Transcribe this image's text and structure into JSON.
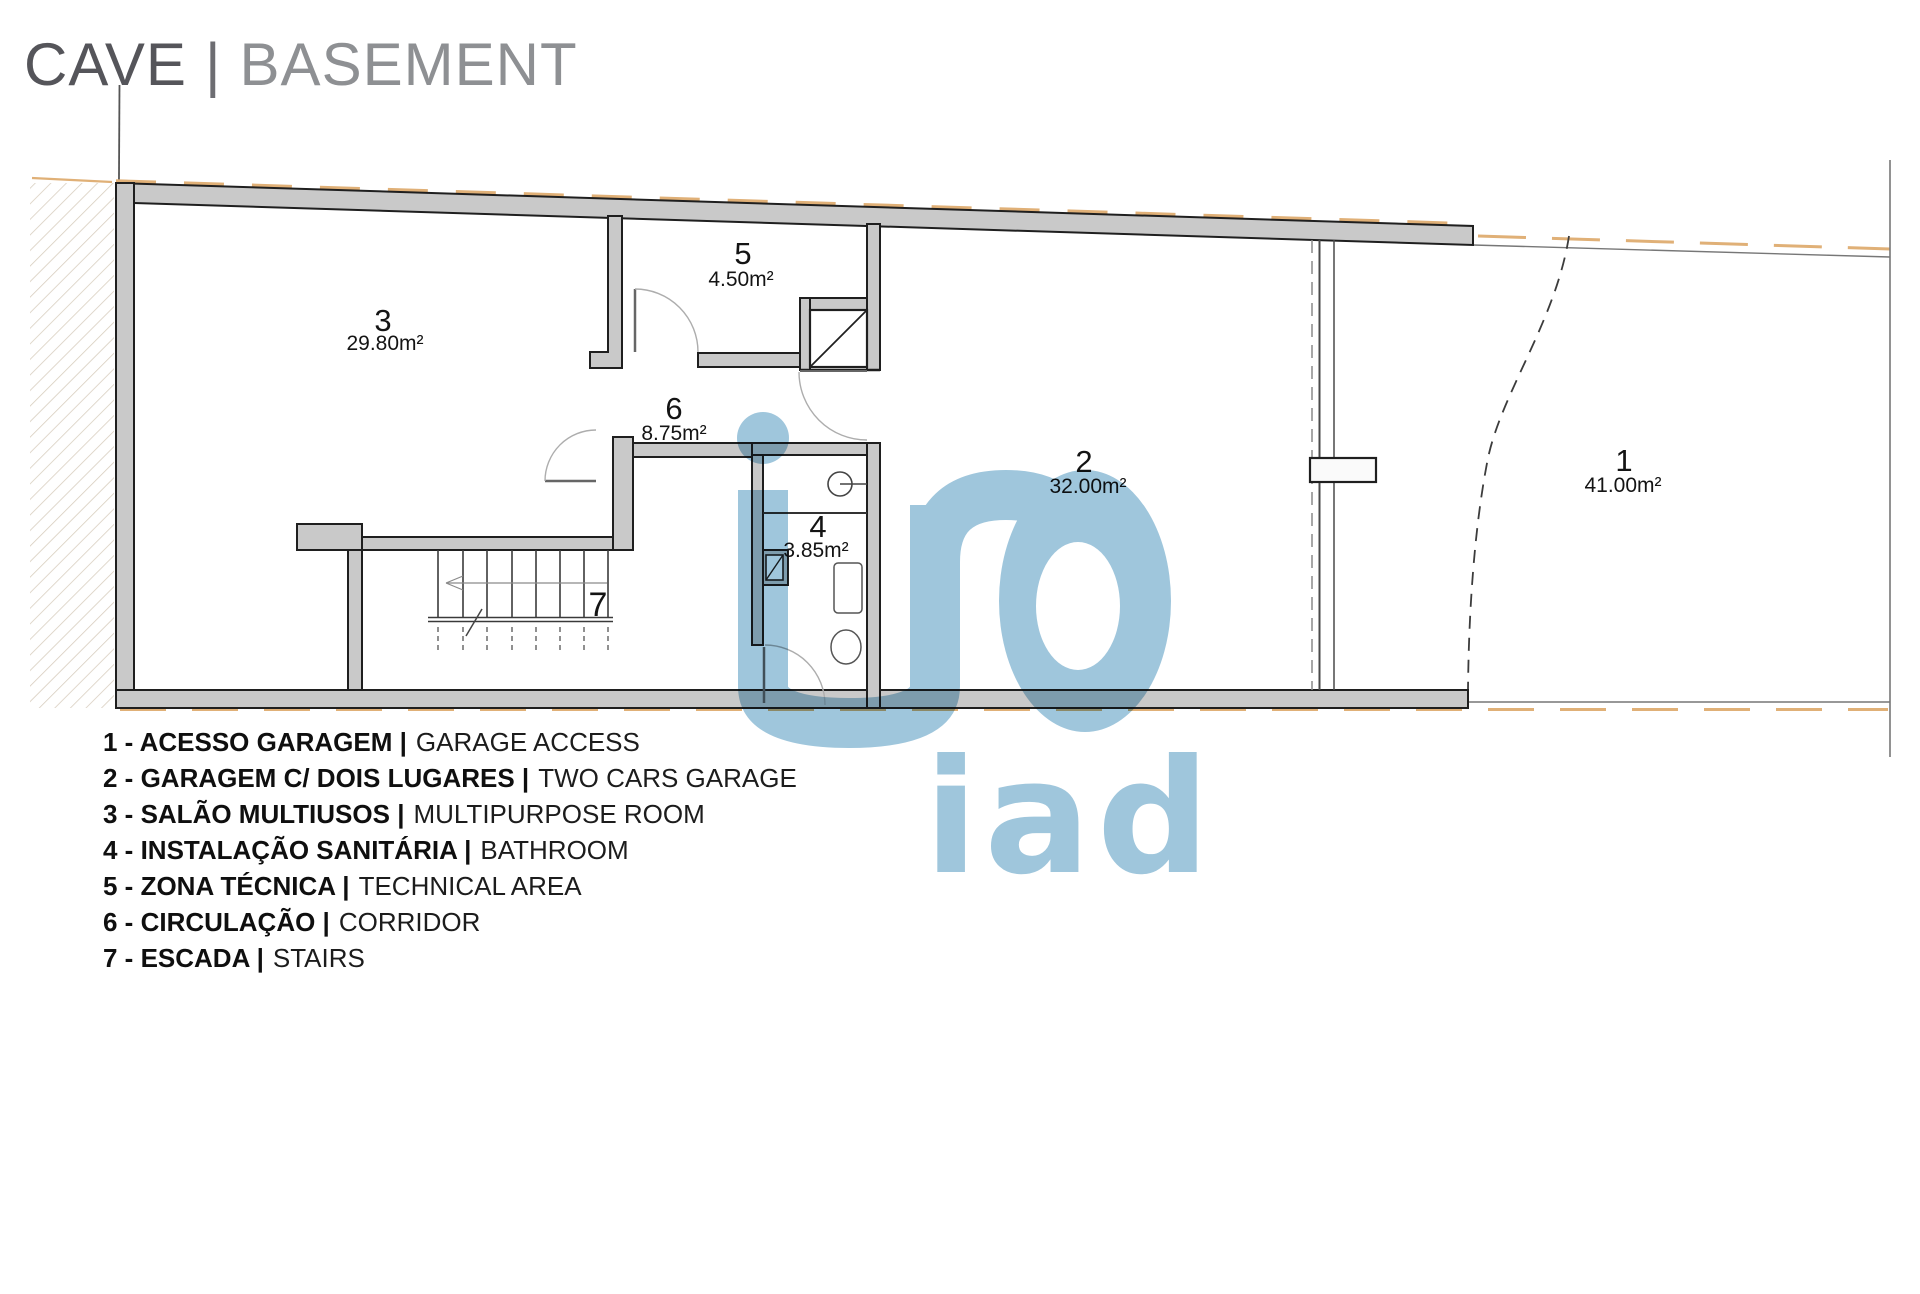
{
  "title": {
    "pt": "CAVE",
    "separator": "|",
    "en": "BASEMENT"
  },
  "plan": {
    "rooms": [
      {
        "num": "1",
        "area": "41.00m²"
      },
      {
        "num": "2",
        "area": "32.00m²"
      },
      {
        "num": "3",
        "area": "29.80m²"
      },
      {
        "num": "4",
        "area": "3.85m²"
      },
      {
        "num": "5",
        "area": "4.50m²"
      },
      {
        "num": "6",
        "area": "8.75m²"
      },
      {
        "num": "7",
        "area": ""
      }
    ]
  },
  "legend": {
    "items": [
      {
        "num": "1",
        "name_pt": "ACESSO GARAGEM",
        "name_en": "GARAGE ACCESS",
        "label_bold": "1 - ACESSO GARAGEM |",
        "label_regular": "GARAGE ACCESS"
      },
      {
        "num": "2",
        "name_pt": "GARAGEM C/ DOIS LUGARES",
        "name_en": "TWO CARS GARAGE",
        "label_bold": "2 - GARAGEM C/ DOIS LUGARES |",
        "label_regular": "TWO CARS GARAGE"
      },
      {
        "num": "3",
        "name_pt": "SALÃO MULTIUSOS",
        "name_en": "MULTIPURPOSE ROOM",
        "label_bold": "3 - SALÃO MULTIUSOS |",
        "label_regular": "MULTIPURPOSE ROOM"
      },
      {
        "num": "4",
        "name_pt": "INSTALAÇÃO SANITÁRIA",
        "name_en": "BATHROOM",
        "label_bold": "4 - INSTALAÇÃO SANITÁRIA |",
        "label_regular": "BATHROOM"
      },
      {
        "num": "5",
        "name_pt": "ZONA TÉCNICA",
        "name_en": "TECHNICAL AREA",
        "label_bold": "5 - ZONA TÉCNICA |",
        "label_regular": "TECHNICAL AREA"
      },
      {
        "num": "6",
        "name_pt": "CIRCULAÇÃO",
        "name_en": "CORRIDOR",
        "label_bold": "6 - CIRCULAÇÃO |",
        "label_regular": "CORRIDOR"
      },
      {
        "num": "7",
        "name_pt": "ESCADA",
        "name_en": "STAIRS",
        "label_bold": "7 - ESCADA |",
        "label_regular": "STAIRS"
      }
    ]
  },
  "watermark": {
    "text": "iad",
    "color": "#9fc6dc"
  },
  "colors": {
    "wall_fill": "#c9c9c9",
    "wall_edge": "#1f1f1f",
    "boundary_gray": "#777777",
    "boundary_orange": "#e0b077",
    "watermark_blue": "#9fc6dc",
    "title_primary": "#55555a",
    "title_secondary": "#8e9093",
    "label_text": "#141414"
  }
}
